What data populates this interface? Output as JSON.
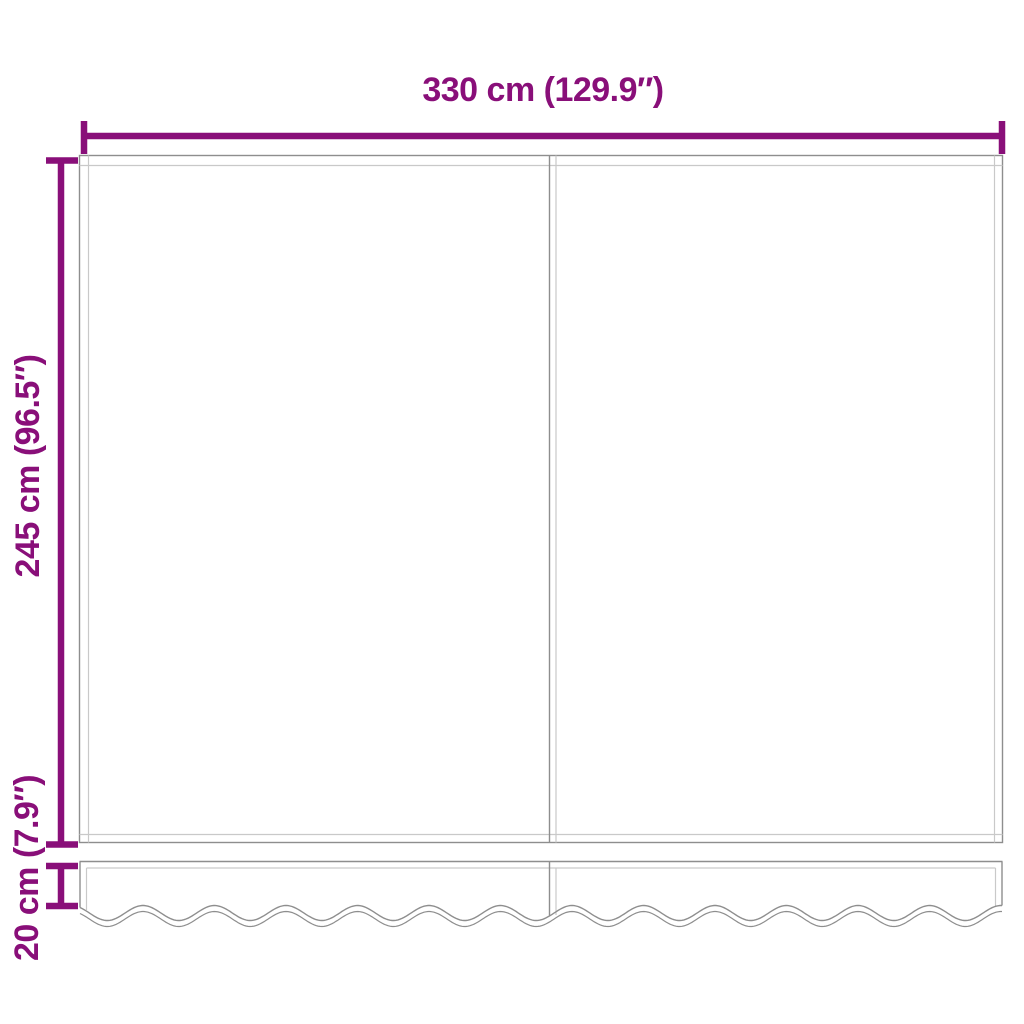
{
  "labels": {
    "width": "330 cm (129.9″)",
    "height": "245 cm (96.5″)",
    "valance_height": "20 cm (7.9″)"
  },
  "colors": {
    "accent": "#890F79",
    "line_dark": "#8E8E8E",
    "line_light": "#C9C9C9",
    "background": "#FFFFFF"
  }
}
